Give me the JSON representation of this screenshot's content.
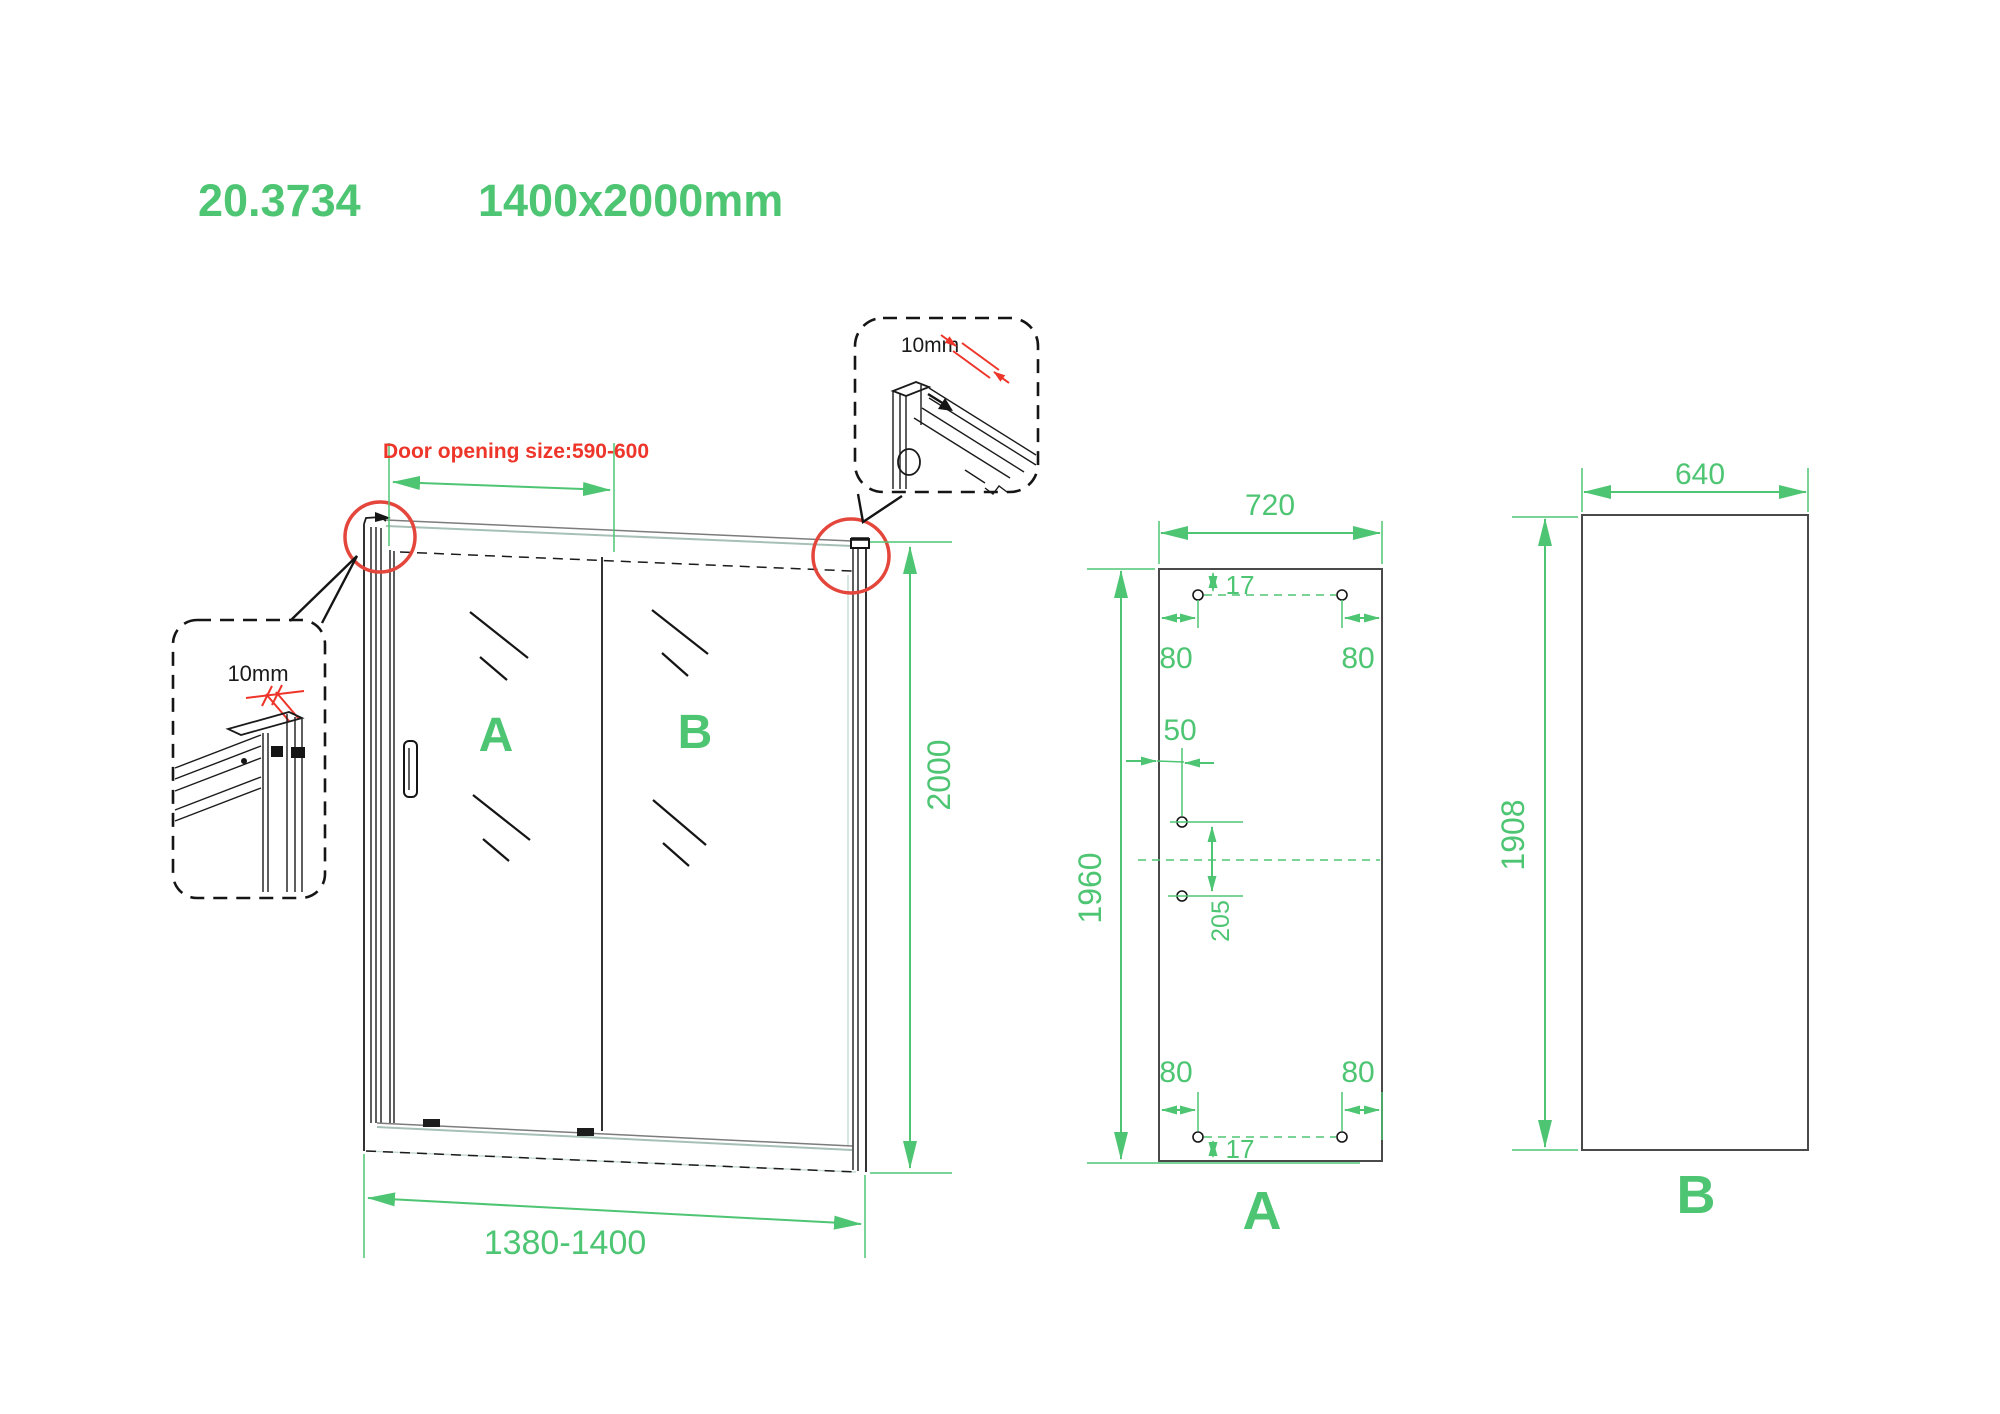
{
  "title": {
    "model": "20.3734",
    "size": "1400x2000mm"
  },
  "colors": {
    "dimension_green": "#4ec573",
    "callout_red": "#e4463c",
    "note_red": "#ee352a",
    "line_black": "#1b1b1b"
  },
  "elevation": {
    "door_opening_note": "Door opening size:590-600",
    "height_dim": "2000",
    "width_dim": "1380-1400",
    "panel_a_glass_label": "A",
    "panel_b_glass_label": "B"
  },
  "detail_left": {
    "gap_label": "10mm"
  },
  "detail_right": {
    "gap_label": "10mm"
  },
  "panel_a": {
    "label": "A",
    "width_dim": "720",
    "height_dim": "1960",
    "hole_edge_top": "17",
    "hole_edge_bottom": "17",
    "hole_left_top": "80",
    "hole_right_top": "80",
    "hole_left_bottom": "80",
    "hole_right_bottom": "80",
    "hole_offset": "50",
    "hole_spacing": "205"
  },
  "panel_b": {
    "label": "B",
    "width_dim": "640",
    "height_dim": "1908"
  }
}
